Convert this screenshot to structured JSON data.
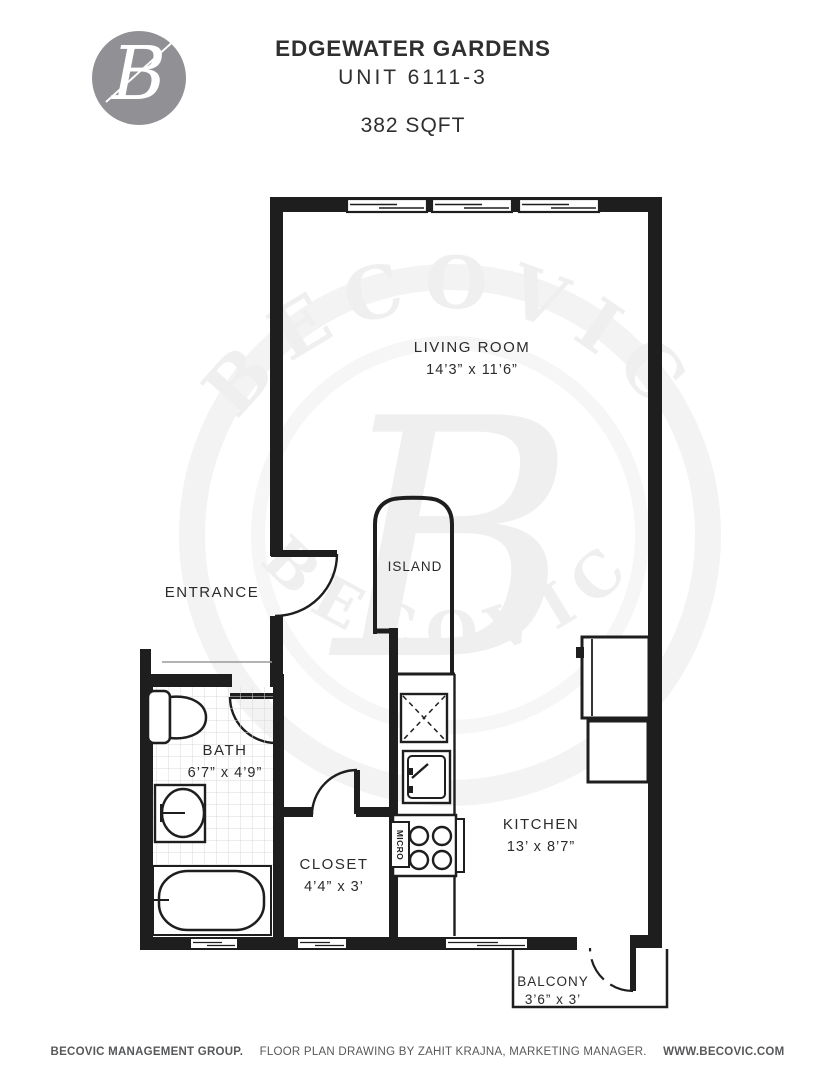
{
  "header": {
    "logo_letter": "B",
    "building": "EDGEWATER GARDENS",
    "unit": "UNIT 6111-3",
    "area": "382 SQFT"
  },
  "rooms": {
    "living_room": {
      "name": "LIVING ROOM",
      "dims": "14’3” x 11’6”"
    },
    "entrance": {
      "name": "ENTRANCE"
    },
    "island": {
      "name": "ISLAND"
    },
    "bath": {
      "name": "BATH",
      "dims": "6’7” x 4’9”"
    },
    "closet": {
      "name": "CLOSET",
      "dims": "4’4” x 3’"
    },
    "kitchen": {
      "name": "KITCHEN",
      "dims": "13’ x 8’7”"
    },
    "balcony": {
      "name": "BALCONY",
      "dims": "3’6” x 3’"
    }
  },
  "appliances": {
    "microwave_label": "MICRO"
  },
  "watermark": {
    "ring_text": "BECOVIC",
    "center_letter": "B"
  },
  "footer": {
    "company": "BECOVIC MANAGEMENT GROUP.",
    "credit": "FLOOR PLAN DRAWING BY ZAHIT KRAJNA, MARKETING MANAGER.",
    "website": "WWW.BECOVIC.COM"
  },
  "colors": {
    "wall": "#1e1e1e",
    "logo_gray": "#919195",
    "footer_text": "#57585a",
    "watermark_gray": "#efefef",
    "label_text": "#2b2b2b"
  }
}
